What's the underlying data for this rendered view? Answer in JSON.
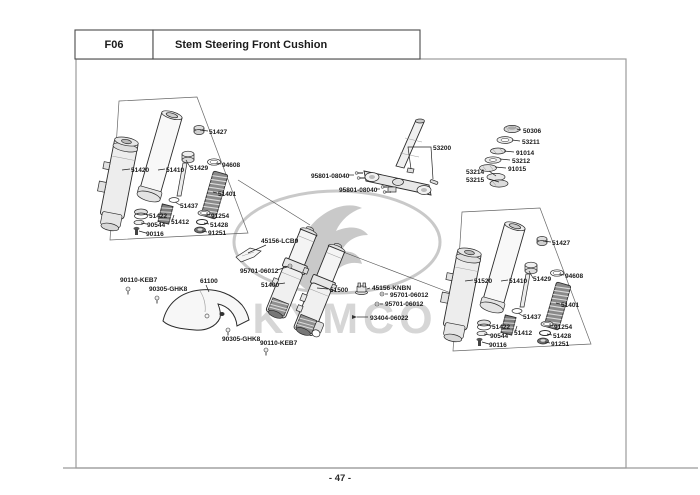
{
  "header": {
    "code": "F06",
    "title": "Stem Steering  Front Cushion"
  },
  "footer": {
    "page_number": "- 47 -"
  },
  "watermark": {
    "brand": "KYMCO"
  },
  "colors": {
    "line": "#1a1a1a",
    "frame": "#9b9b9b",
    "watermark": "#d6d6d6",
    "paper": "#ffffff"
  },
  "parts": {
    "left_assembly": [
      "51427",
      "51420",
      "51410",
      "51429",
      "94608",
      "51401",
      "51437",
      "51422",
      "51412",
      "91254",
      "90544",
      "51428",
      "90116",
      "91251"
    ],
    "right_assembly": [
      "51427",
      "51520",
      "51410",
      "51429",
      "94608",
      "51401",
      "51437",
      "51422",
      "51412",
      "91254",
      "90544",
      "51428",
      "90116",
      "91251"
    ],
    "steering": [
      "53200",
      "95801-08040",
      "95801-08040"
    ],
    "bearing_stack": [
      "50306",
      "53211",
      "91014",
      "53212",
      "91015",
      "53214",
      "53215"
    ],
    "center": [
      "45156-LCB9",
      "95701-06012",
      "51400",
      "51500",
      "45156-KNBN",
      "95701-06012",
      "95701-06012",
      "93404-06022"
    ],
    "fender": [
      "90110-KEB7",
      "90305-GHK8",
      "61100",
      "90305-GHK8",
      "90110-KEB7"
    ]
  }
}
